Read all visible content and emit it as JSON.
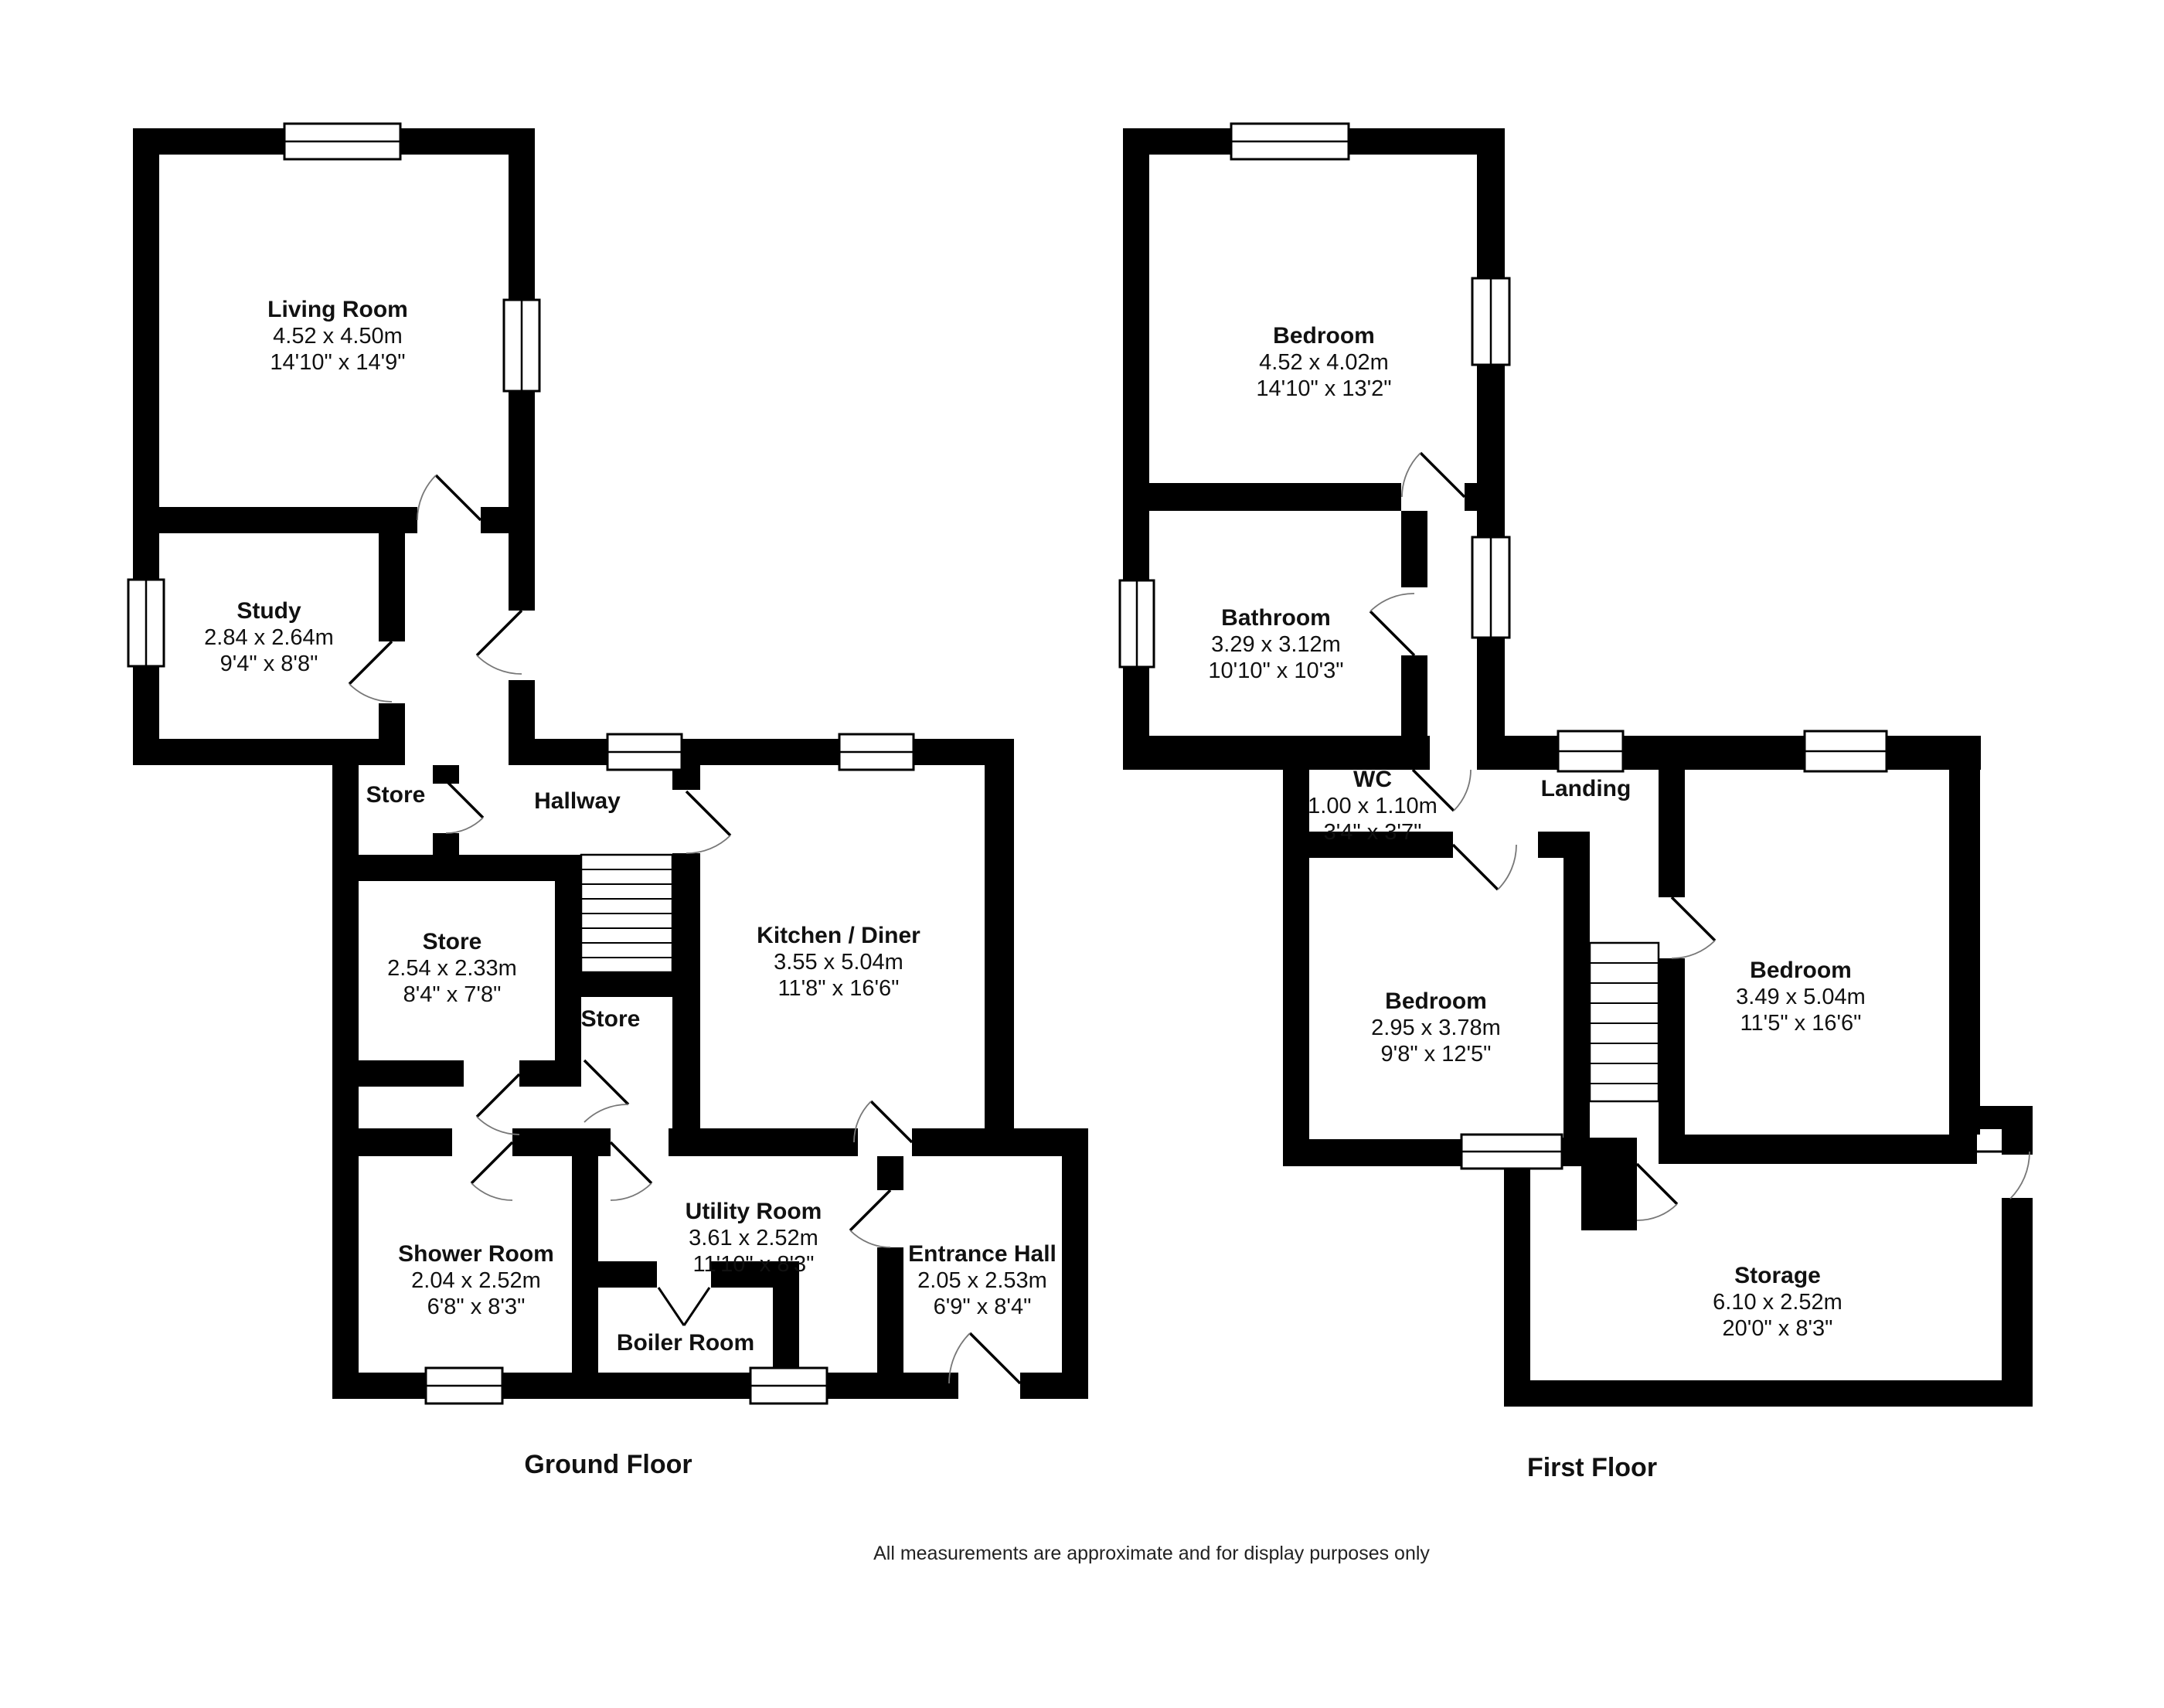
{
  "footer": {
    "disclaimer": "All measurements are approximate and for display purposes only"
  },
  "ground_floor": {
    "title": "Ground Floor",
    "rooms": [
      {
        "name": "Living Room",
        "metric": "4.52 x 4.50m",
        "imperial": "14'10\" x 14'9\""
      },
      {
        "name": "Study",
        "metric": "2.84 x 2.64m",
        "imperial": "9'4\" x 8'8\""
      },
      {
        "name": "Store"
      },
      {
        "name": "Hallway"
      },
      {
        "name": "Store",
        "metric": "2.54 x 2.33m",
        "imperial": "8'4\" x 7'8\""
      },
      {
        "name": "Store"
      },
      {
        "name": "Kitchen / Diner",
        "metric": "3.55 x 5.04m",
        "imperial": "11'8\" x 16'6\""
      },
      {
        "name": "Shower Room",
        "metric": "2.04 x 2.52m",
        "imperial": "6'8\" x 8'3\""
      },
      {
        "name": "Utility Room",
        "metric": "3.61 x 2.52m",
        "imperial": "11'10\" x 8'3\""
      },
      {
        "name": "Boiler Room"
      },
      {
        "name": "Entrance Hall",
        "metric": "2.05 x 2.53m",
        "imperial": "6'9\" x 8'4\""
      }
    ]
  },
  "first_floor": {
    "title": "First Floor",
    "rooms": [
      {
        "name": "Bedroom",
        "metric": "4.52 x 4.02m",
        "imperial": "14'10\" x 13'2\""
      },
      {
        "name": "Bathroom",
        "metric": "3.29 x 3.12m",
        "imperial": "10'10\" x 10'3\""
      },
      {
        "name": "WC",
        "metric": "1.00 x 1.10m",
        "imperial": "3'4\" x 3'7\""
      },
      {
        "name": "Landing"
      },
      {
        "name": "Bedroom",
        "metric": "2.95 x 3.78m",
        "imperial": "9'8\" x 12'5\""
      },
      {
        "name": "Bedroom",
        "metric": "3.49 x 5.04m",
        "imperial": "11'5\" x 16'6\""
      },
      {
        "name": "Storage",
        "metric": "6.10 x 2.52m",
        "imperial": "20'0\" x 8'3\""
      }
    ]
  }
}
